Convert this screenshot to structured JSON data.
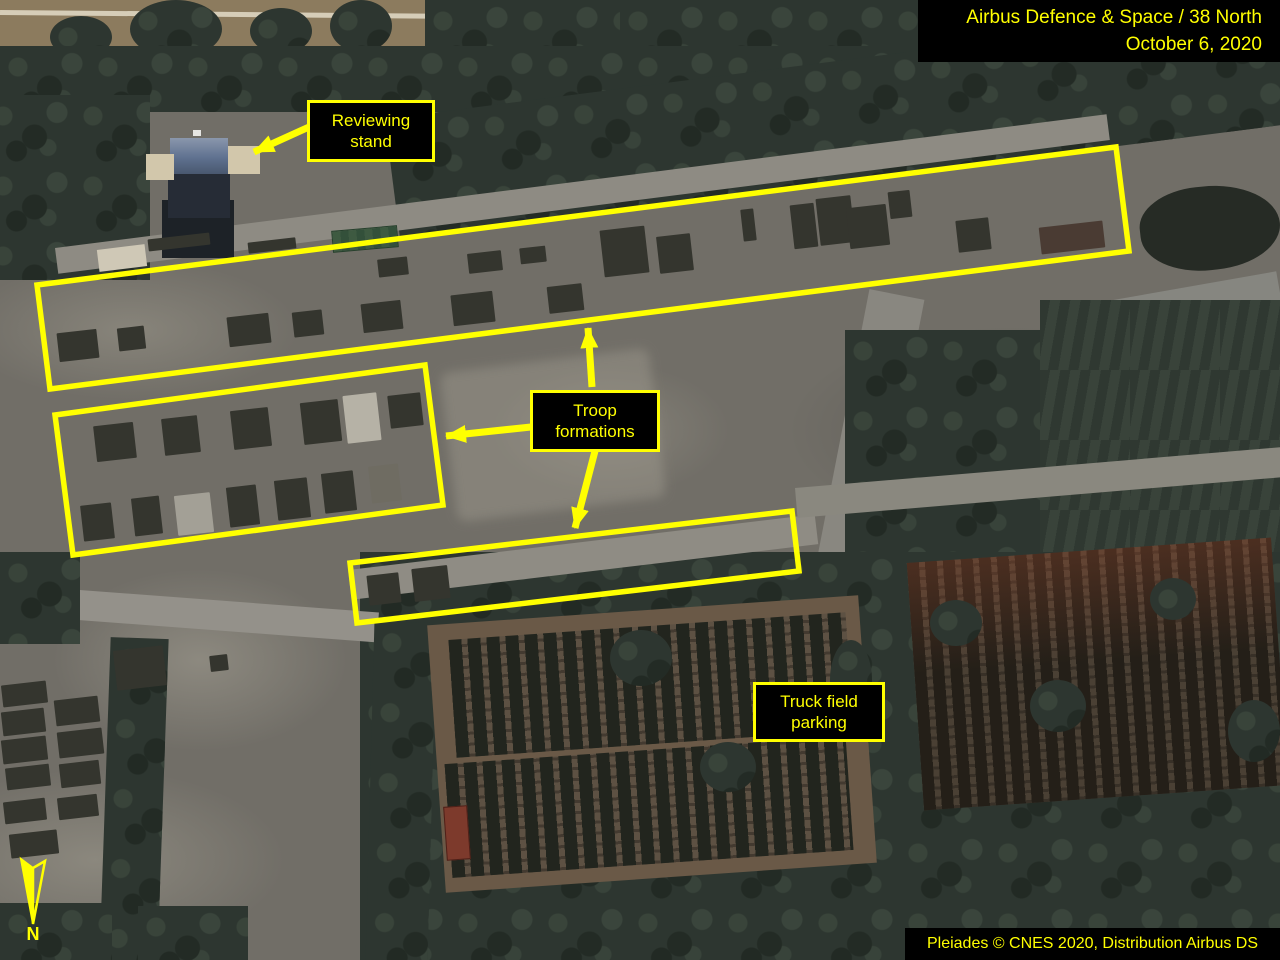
{
  "overlay": {
    "source_line1": "Airbus Defence & Space / 38 North",
    "source_line2": "October 6, 2020",
    "labels": {
      "reviewing_stand": "Reviewing stand",
      "troop_formations": "Troop formations",
      "truck_parking": "Truck field parking"
    },
    "credit": "Pleiades © CNES 2020, Distribution Airbus DS",
    "north": "N",
    "colors": {
      "annotation_yellow": "#ffff00",
      "label_bg": "#000000"
    }
  },
  "scene": {
    "troop_formation_blocks": [
      [
        95,
        424,
        40,
        36
      ],
      [
        163,
        417,
        36,
        37
      ],
      [
        232,
        409,
        38,
        39
      ],
      [
        302,
        401,
        38,
        42
      ],
      [
        345,
        394,
        34,
        48,
        "#b6b2a6"
      ],
      [
        389,
        394,
        33,
        33
      ],
      [
        82,
        504,
        31,
        36
      ],
      [
        133,
        497,
        28,
        38
      ],
      [
        176,
        494,
        36,
        40,
        "#a3a096"
      ],
      [
        228,
        486,
        30,
        40
      ],
      [
        276,
        479,
        33,
        40
      ],
      [
        323,
        472,
        32,
        40
      ],
      [
        370,
        465,
        30,
        37,
        "#6f6c62"
      ],
      [
        58,
        331,
        40,
        29
      ],
      [
        118,
        327,
        27,
        23
      ],
      [
        228,
        315,
        42,
        30
      ],
      [
        293,
        311,
        30,
        25
      ],
      [
        362,
        302,
        40,
        29
      ],
      [
        452,
        293,
        42,
        31
      ],
      [
        548,
        285,
        35,
        27
      ],
      [
        602,
        228,
        45,
        47
      ],
      [
        658,
        235,
        34,
        37
      ],
      [
        742,
        209,
        13,
        32
      ],
      [
        792,
        204,
        24,
        44
      ],
      [
        818,
        197,
        35,
        47
      ],
      [
        848,
        206,
        40,
        41
      ],
      [
        889,
        191,
        22,
        27
      ],
      [
        957,
        219,
        33,
        32
      ],
      [
        1040,
        224,
        64,
        27,
        "#4a3b33"
      ],
      [
        148,
        236,
        62,
        12
      ],
      [
        248,
        240,
        48,
        11
      ],
      [
        378,
        258,
        30,
        18
      ],
      [
        468,
        252,
        34,
        20
      ],
      [
        520,
        247,
        26,
        16
      ],
      [
        368,
        574,
        32,
        30
      ],
      [
        413,
        567,
        36,
        33
      ],
      [
        2,
        683,
        45,
        22
      ],
      [
        2,
        710,
        43,
        24
      ],
      [
        2,
        738,
        45,
        24
      ],
      [
        6,
        766,
        44,
        22
      ],
      [
        55,
        698,
        44,
        26
      ],
      [
        58,
        730,
        45,
        26
      ],
      [
        60,
        762,
        40,
        24
      ],
      [
        4,
        800,
        42,
        22
      ],
      [
        58,
        796,
        40,
        22
      ],
      [
        10,
        832,
        48,
        24
      ],
      [
        115,
        648,
        50,
        40
      ],
      [
        210,
        655,
        18,
        16
      ]
    ]
  }
}
